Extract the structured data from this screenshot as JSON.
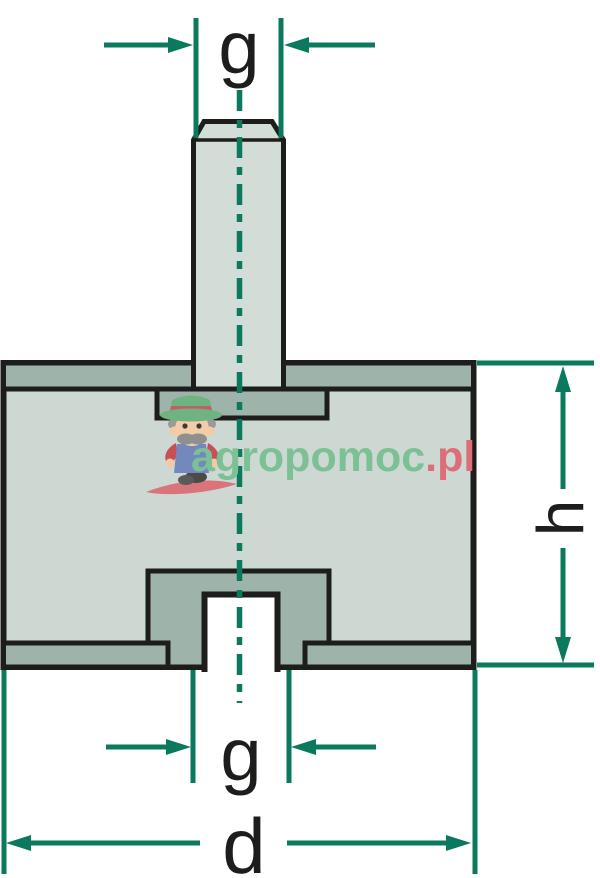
{
  "diagram": {
    "type": "technical-drawing",
    "subject": "rubber-metal bobbin vibration mount, cross-section with threaded stud on top and threaded hole at bottom",
    "labels": {
      "thread_top": "g",
      "thread_bottom": "g",
      "height": "h",
      "diameter": "d"
    },
    "watermark": {
      "brand_green": "agropomoc",
      "brand_red": ".pl",
      "mascot": "farmer-mascot-icon"
    },
    "colors": {
      "dimension_lines": "#0a795d",
      "outline": "#1d1d1b",
      "body_fill": "#cdd8d2",
      "metal_fill": "#9eb4ab",
      "stud_fill": "#d3ddd7",
      "hole_fill": "#ffffff",
      "watermark_green": "#7cc096",
      "watermark_red": "#dc6d79",
      "label_text": "#1d1d1b"
    }
  }
}
